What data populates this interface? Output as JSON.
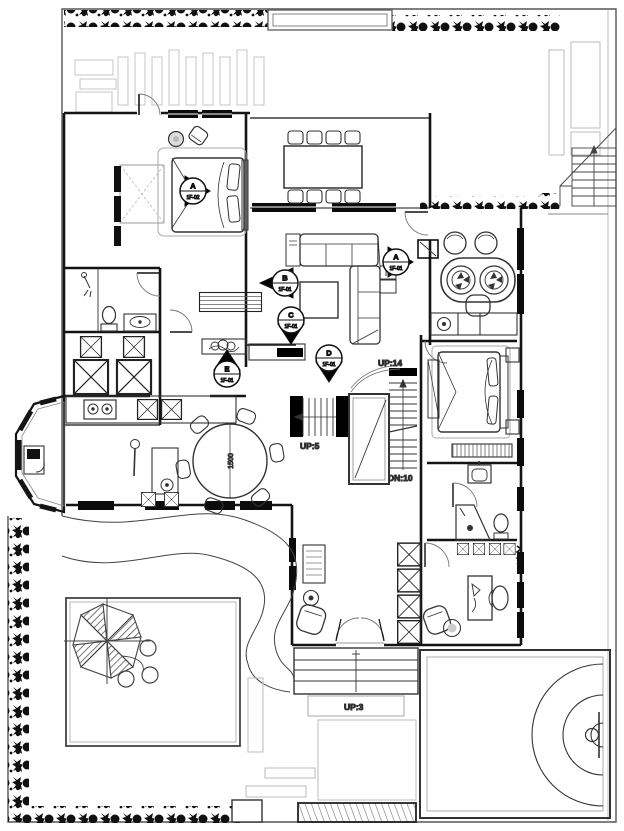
{
  "colors": {
    "ink": "#1b1b1b",
    "furniture": "#333333",
    "light_gray": "#c4c4c4",
    "mid_gray": "#8a8a8a",
    "background": "#ffffff"
  },
  "labels": {
    "up14": "UP:14",
    "up5": "UP:5",
    "dn10": "DN:10",
    "up3": "UP:3"
  },
  "dining": {
    "table_diameter": "1500"
  },
  "markers": {
    "a1": {
      "letter": "A",
      "level": "1F-02"
    },
    "b": {
      "letter": "B",
      "level": "1F-01"
    },
    "c": {
      "letter": "C",
      "level": "1F-01"
    },
    "d": {
      "letter": "D",
      "level": "1F-01"
    },
    "a2": {
      "letter": "A",
      "level": "1F-01"
    },
    "e": {
      "letter": "E",
      "level": "1F-01"
    }
  }
}
